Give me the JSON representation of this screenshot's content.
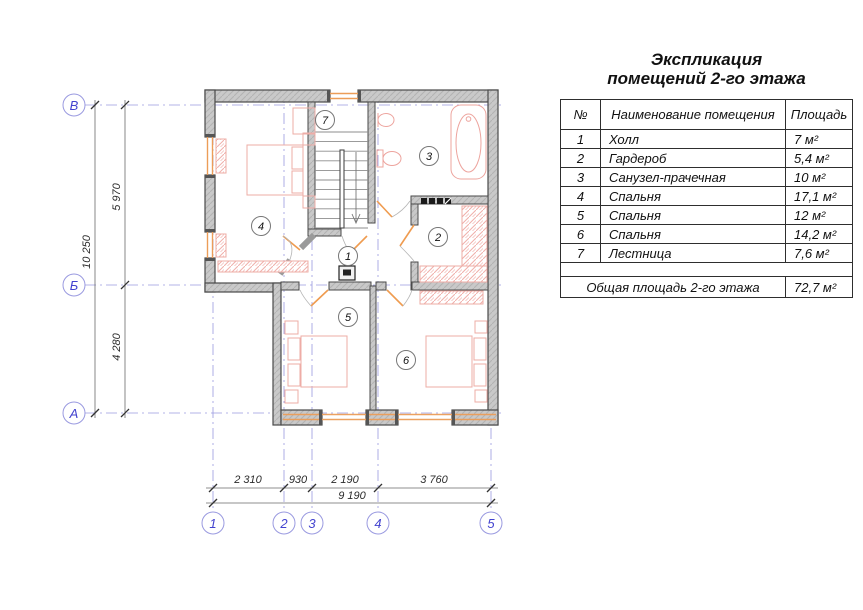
{
  "title": {
    "line1": "Экспликация",
    "line2": "помещений 2-го этажа"
  },
  "table": {
    "headers": {
      "num": "№",
      "name": "Наименование помещения",
      "area": "Площадь"
    },
    "rows": [
      {
        "num": "1",
        "name": "Холл",
        "area": "7 м²"
      },
      {
        "num": "2",
        "name": "Гардероб",
        "area": "5,4 м²"
      },
      {
        "num": "3",
        "name": "Санузел-прачечная",
        "area": "10 м²"
      },
      {
        "num": "4",
        "name": "Спальня",
        "area": "17,1 м²"
      },
      {
        "num": "5",
        "name": "Спальня",
        "area": "12 м²"
      },
      {
        "num": "6",
        "name": "Спальня",
        "area": "14,2 м²"
      },
      {
        "num": "7",
        "name": "Лестница",
        "area": "7,6 м²"
      }
    ],
    "total": {
      "label": "Общая площадь 2-го этажа",
      "area": "72,7 м²"
    }
  },
  "plan": {
    "rooms": [
      "1",
      "2",
      "3",
      "4",
      "5",
      "6",
      "7"
    ],
    "axes_h": [
      "В",
      "Б",
      "А"
    ],
    "axes_v": [
      "1",
      "2",
      "3",
      "4",
      "5"
    ],
    "dims": {
      "bottom": [
        "2 310",
        "930",
        "2 190",
        "3 760"
      ],
      "bottom_total": "9 190",
      "left": [
        "5 970",
        "4 280"
      ],
      "left_total": "10 250"
    }
  },
  "colors": {
    "wall": "#c9c9c9",
    "wall_edge": "#4a4a4a",
    "window_orange": "#ec9d58",
    "furniture_pink": "#eeaca6",
    "axis_blue": "#9a9ae0",
    "axis_text": "#4343cf",
    "dim_text": "#2b2b2b"
  }
}
